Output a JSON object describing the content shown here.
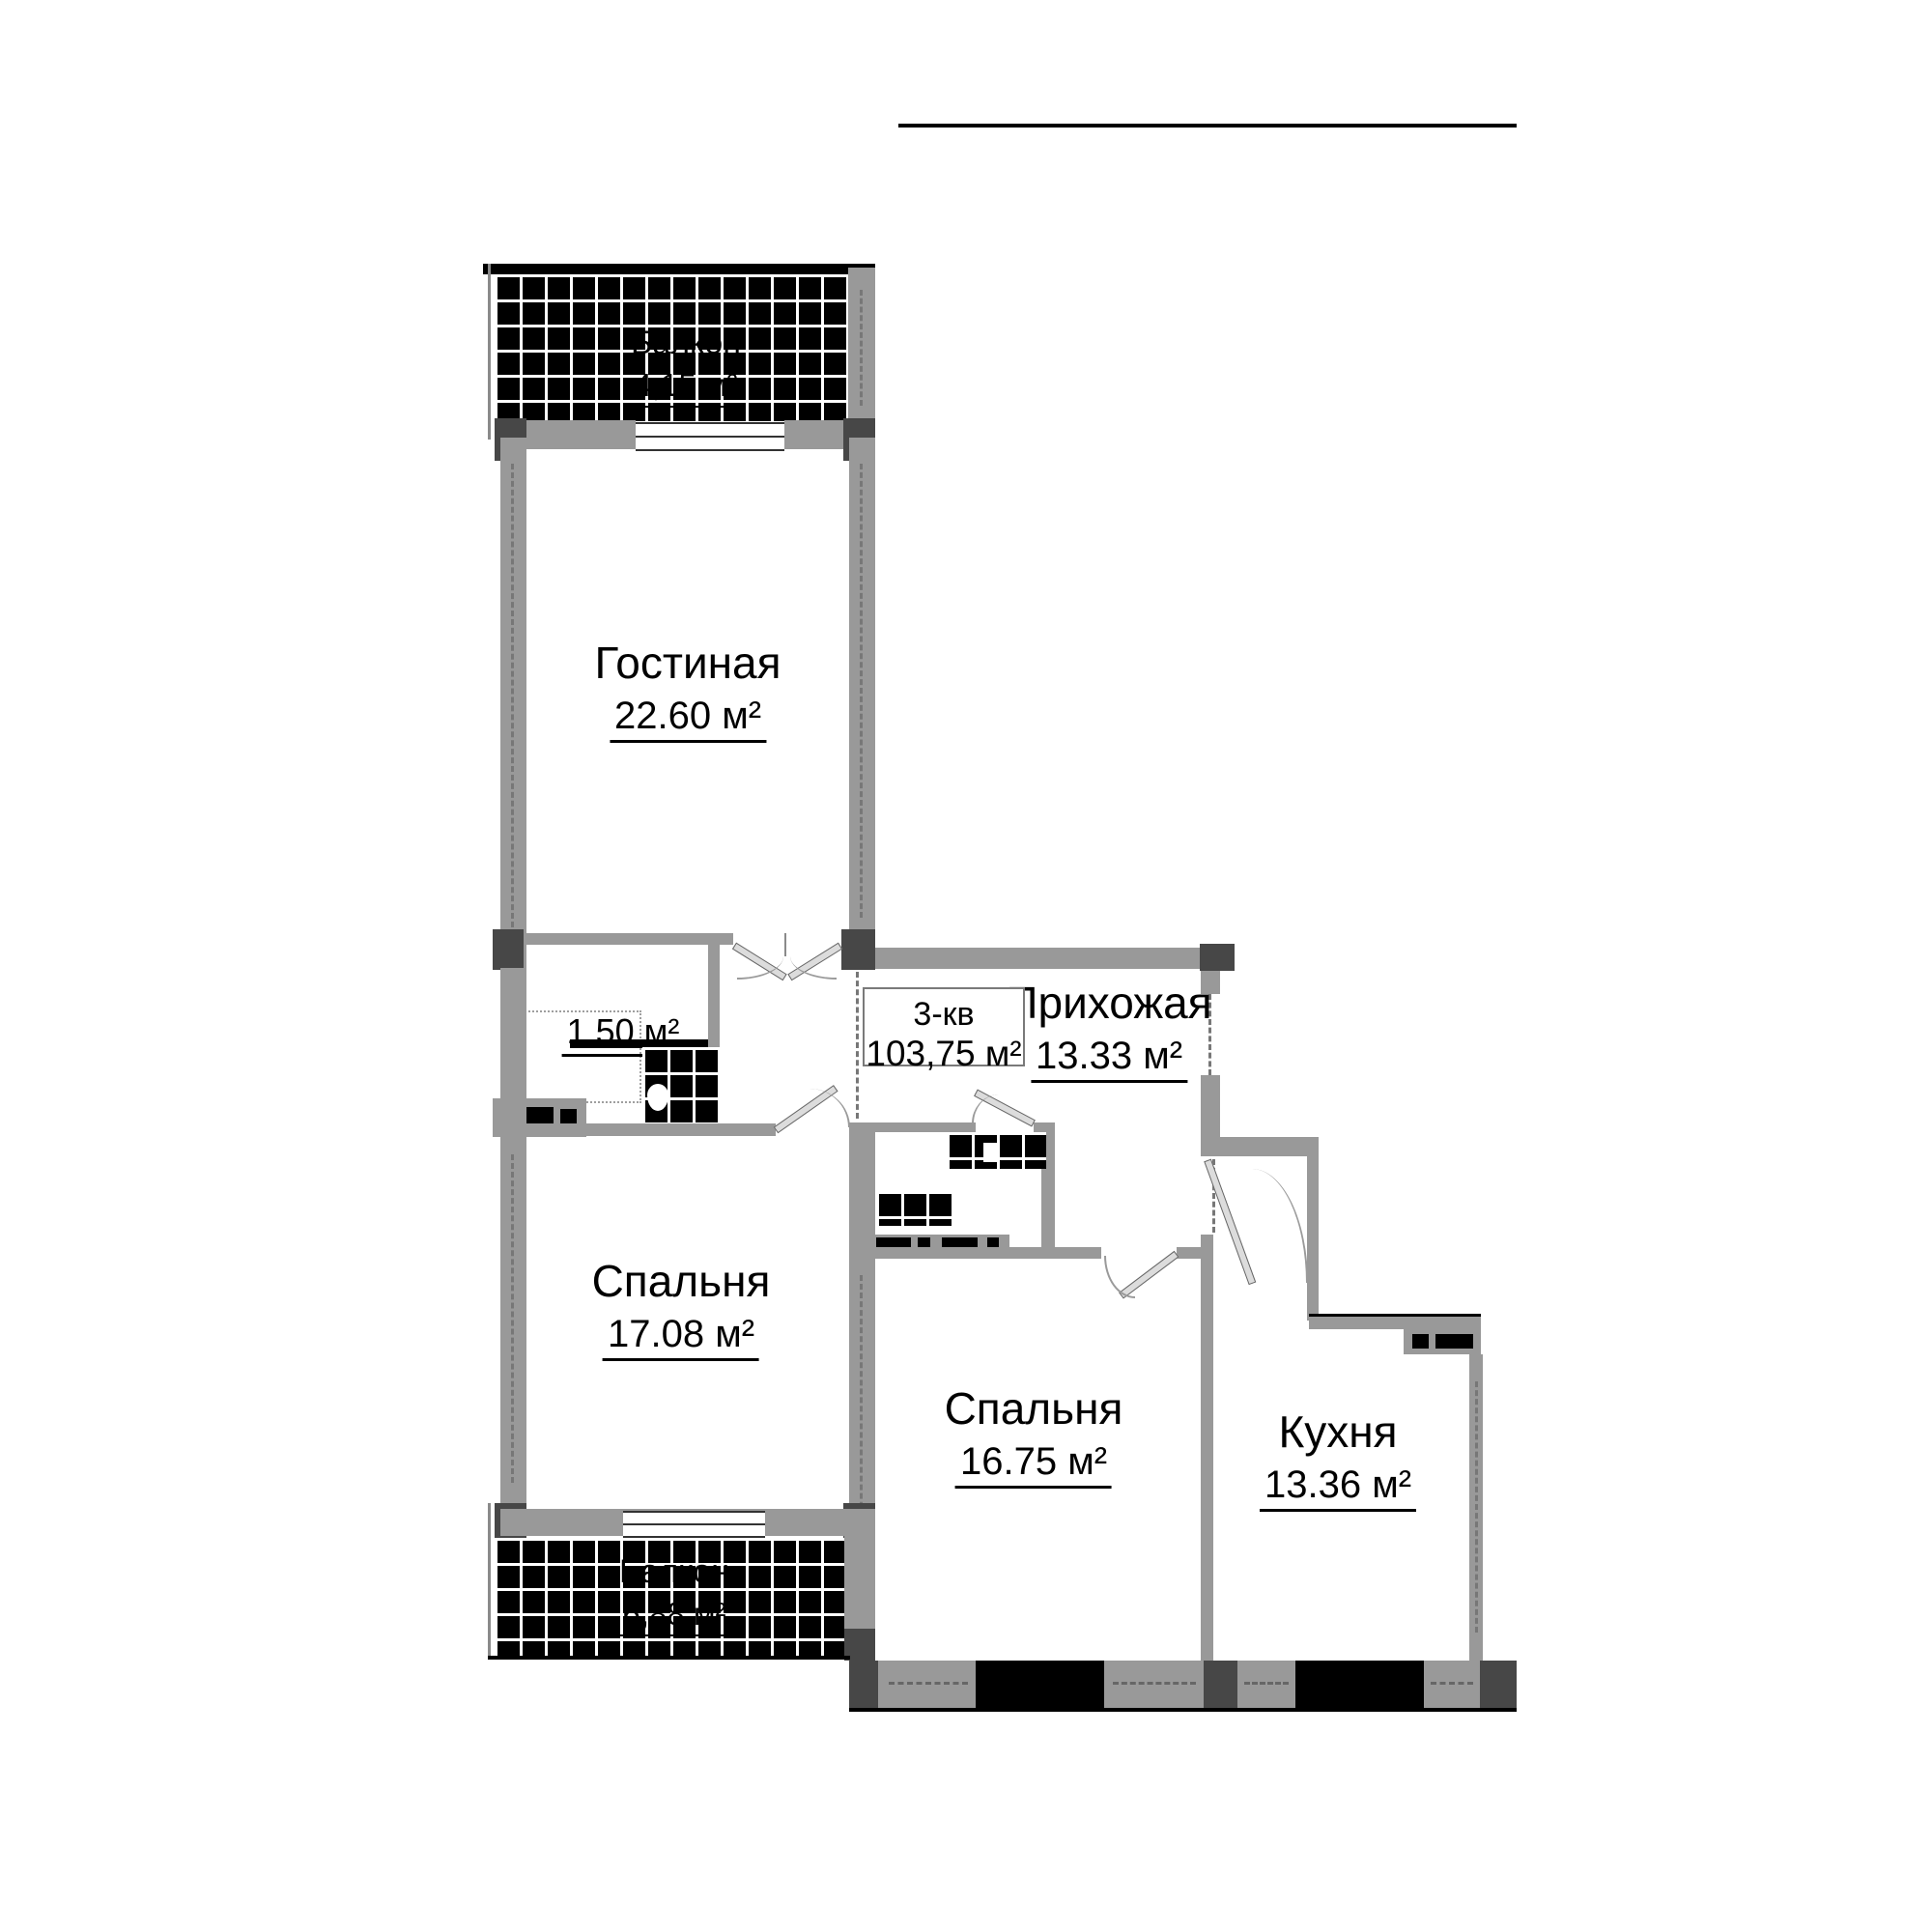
{
  "apartment": {
    "type_label": "3-кв",
    "total_area": "103,75 м²"
  },
  "rooms": [
    {
      "name": "Гостиная",
      "area": "22.60 м²"
    },
    {
      "name": "Прихожая",
      "area": "13.33 м²"
    },
    {
      "name": "Спальня",
      "area": "17.08 м²"
    },
    {
      "name": "Спальня",
      "area": "16.75 м²"
    },
    {
      "name": "Кухня",
      "area": "13.36 м²"
    }
  ],
  "closet": {
    "area": "1,50 м²"
  },
  "balconies": [
    {
      "name": "Балкон",
      "area": "4,15 м²"
    },
    {
      "name": "Балкон",
      "area": "6,88 м²"
    }
  ],
  "colors": {
    "wall": "#999999",
    "column": "#474747",
    "hatch_bg": "#000000",
    "line": "#000000",
    "background": "#ffffff"
  }
}
